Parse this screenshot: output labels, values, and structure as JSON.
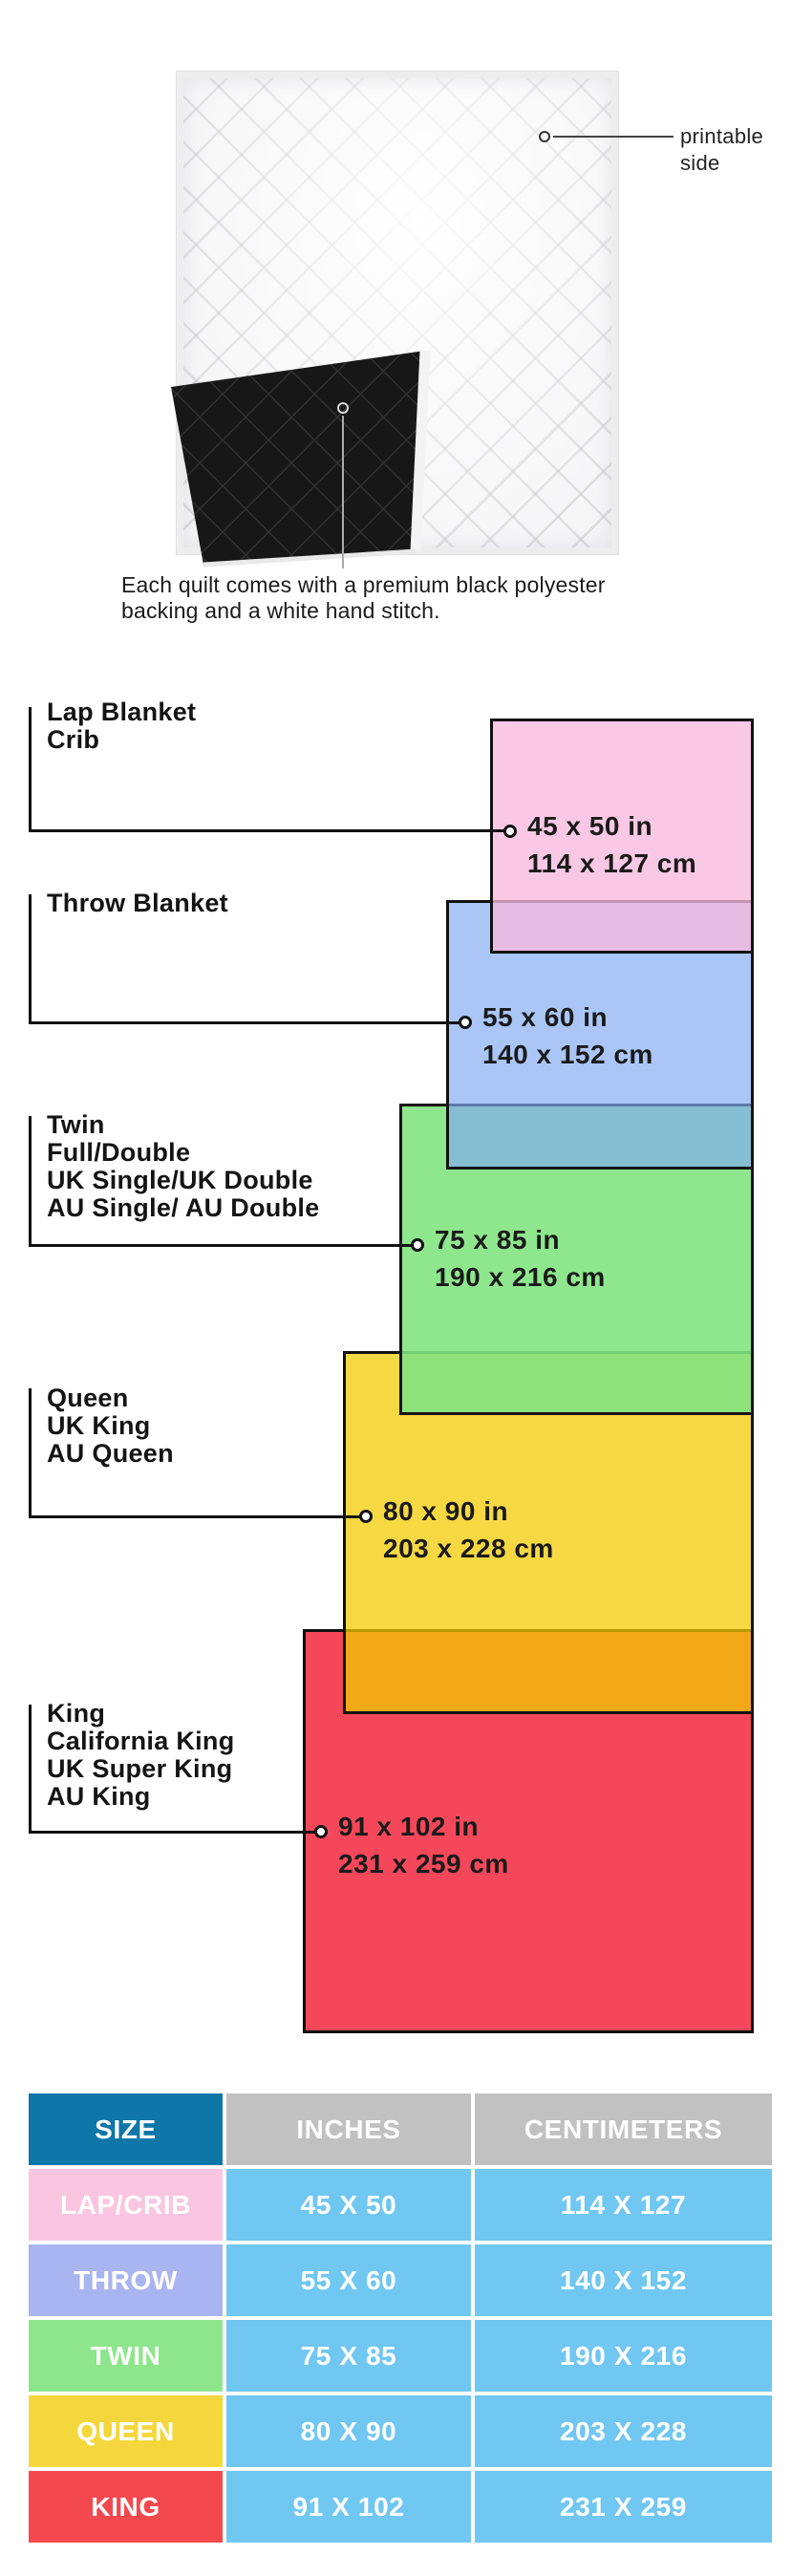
{
  "quilt": {
    "printable_lines": [
      "printable",
      "side"
    ],
    "caption_lines": [
      "Each quilt comes with a premium black polyester",
      "backing and a white hand stitch."
    ]
  },
  "diagram": {
    "border_color": "#111111",
    "blocks": [
      {
        "names": [
          "Lap Blanket",
          "Crib"
        ],
        "inches": "45 x 50 in",
        "cm": "114 x 127 cm",
        "fill": "rgba(247,184,220,0.78)"
      },
      {
        "names": [
          "Throw Blanket"
        ],
        "inches": "55 x 60 in",
        "cm": "140 x 152 cm",
        "fill": "rgba(128,171,243,0.68)"
      },
      {
        "names": [
          "Twin",
          "Full/Double",
          "UK Single/UK Double",
          "AU Single/ AU Double"
        ],
        "inches": "75 x 85 in",
        "cm": "190 x 216 cm",
        "fill": "rgba(130,228,128,0.9)"
      },
      {
        "names": [
          "Queen",
          "UK King",
          "AU Queen"
        ],
        "inches": "80 x 90 in",
        "cm": "203 x 228 cm",
        "fill": "rgba(243,202,0,0.74)"
      },
      {
        "names": [
          "King",
          "California King",
          "UK Super King",
          "AU King"
        ],
        "inches": "91 x 102 in",
        "cm": "231 x 259 cm",
        "fill": "rgba(244,72,90,1)"
      }
    ]
  },
  "table": {
    "headers": [
      "SIZE",
      "INCHES",
      "CENTIMETERS"
    ],
    "header_colors": {
      "size_bg": "#0E76A8",
      "other_bg": "#C1C1C1"
    },
    "value_bg": "#70C7F1",
    "rows": [
      {
        "size": "LAP/CRIB",
        "inches": "45 X 50",
        "cm": "114 X 127",
        "color": "#FAC5E1"
      },
      {
        "size": "THROW",
        "inches": "55 X 60",
        "cm": "140 X 152",
        "color": "#A9B5F0"
      },
      {
        "size": "TWIN",
        "inches": "75 X 85",
        "cm": "190 X 216",
        "color": "#8EE68C"
      },
      {
        "size": "QUEEN",
        "inches": "80 X 90",
        "cm": "203 X 228",
        "color": "#F4D73C"
      },
      {
        "size": "KING",
        "inches": "91 X 102",
        "cm": "231 X 259",
        "color": "#F4484F"
      }
    ]
  }
}
